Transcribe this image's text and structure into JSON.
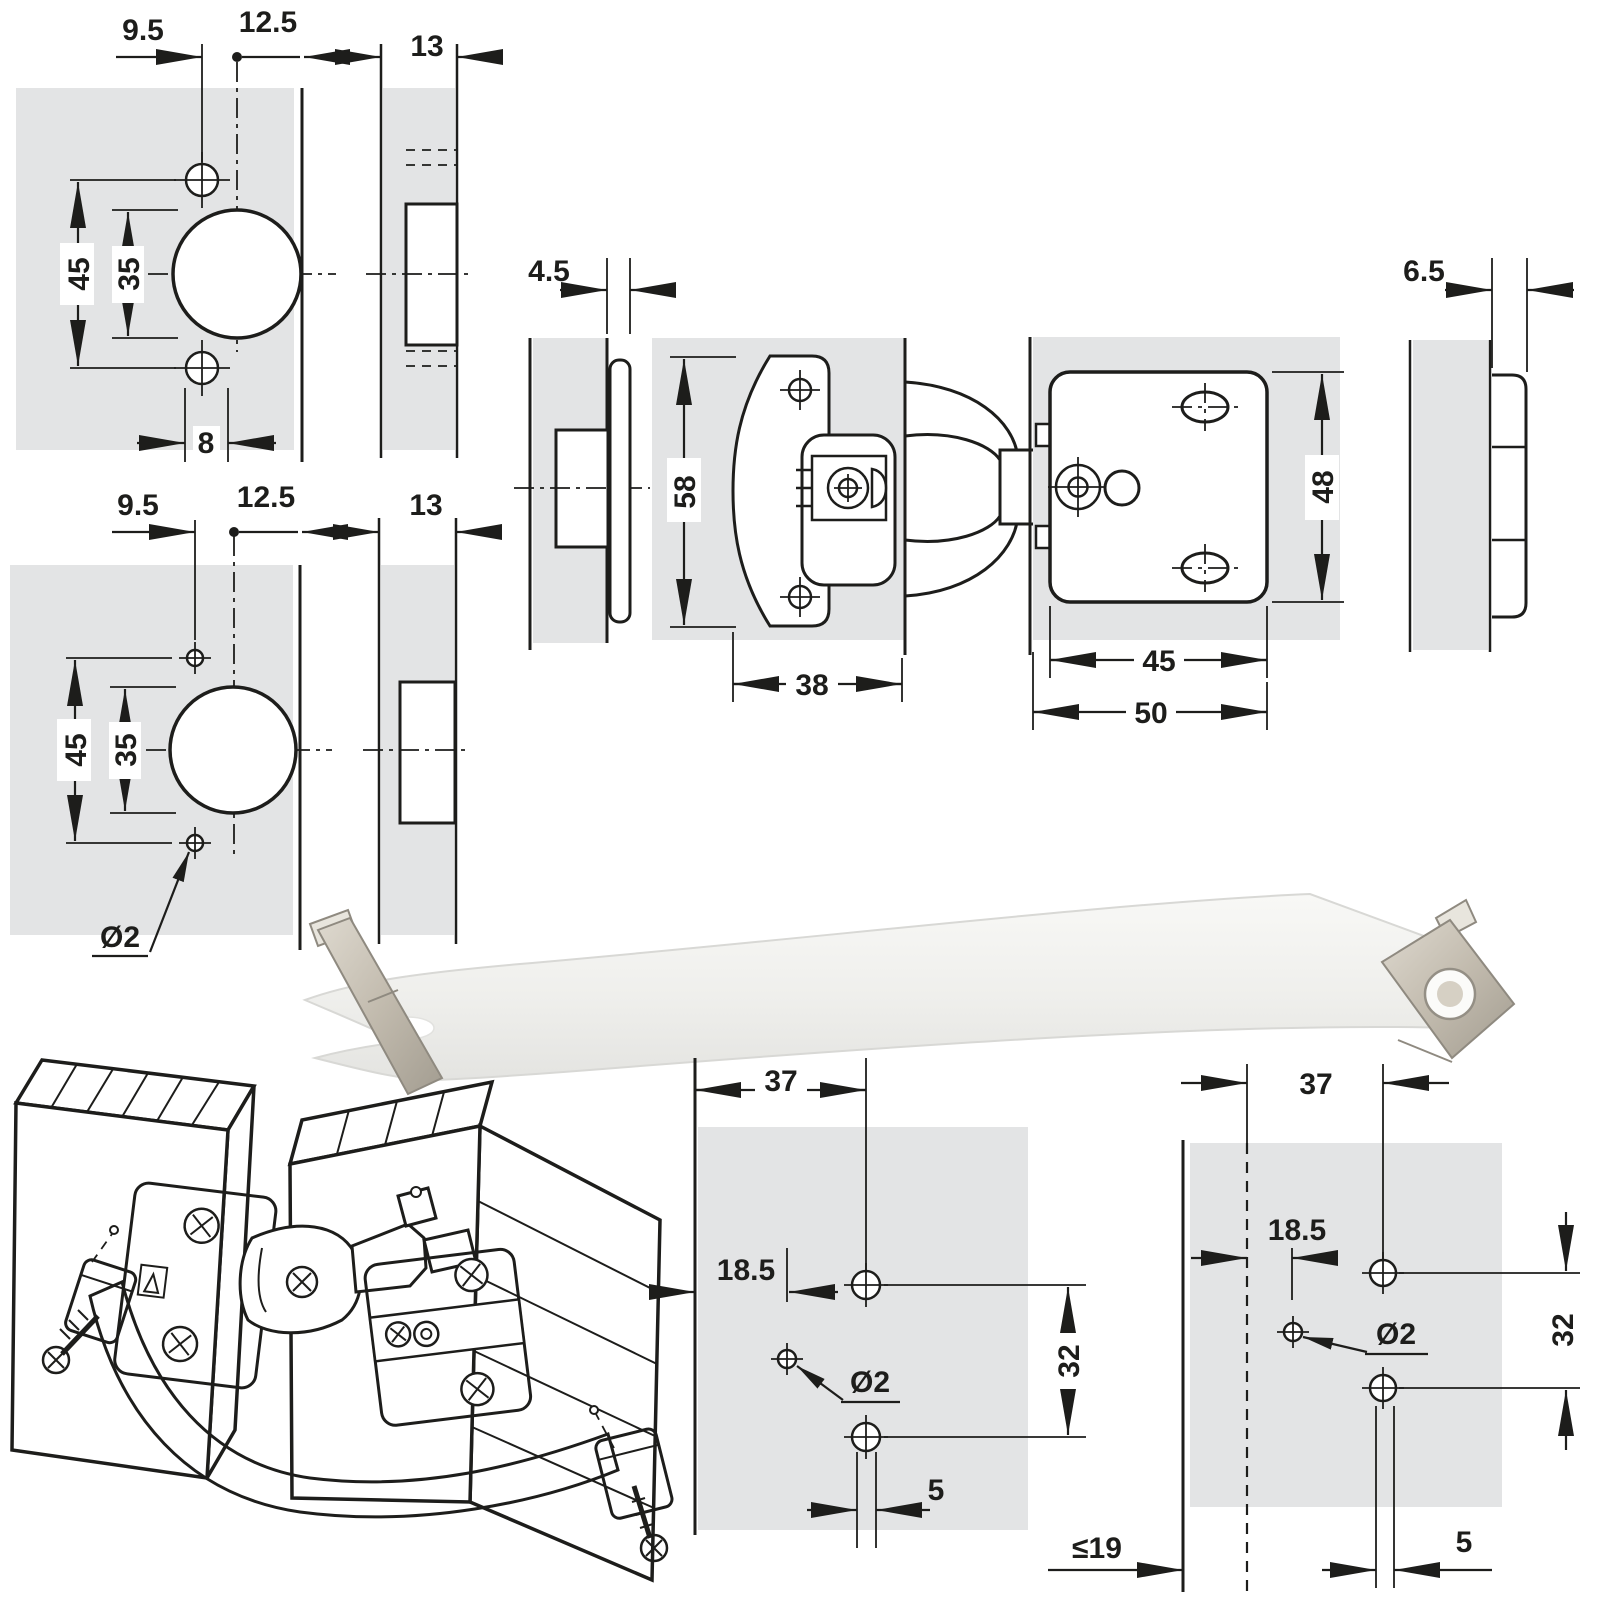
{
  "colors": {
    "background": "#ffffff",
    "panel_fill": "#e3e4e5",
    "line": "#1d1d1b",
    "strap_band": "#f2f2ef",
    "strap_metal": "#c2bbae",
    "iso_strap": "#c9cbcd"
  },
  "diagrams": {
    "cup_pattern_screw": {
      "edge_offset": "9.5",
      "cup_to_edge": "12.5",
      "door_thickness": "13",
      "hole_spacing": "45",
      "cup_diameter": "35",
      "screw_hole_offset": "8"
    },
    "cup_pattern_pilot": {
      "edge_offset": "9.5",
      "cup_to_edge": "12.5",
      "door_thickness": "13",
      "hole_spacing": "45",
      "cup_diameter": "35",
      "pilot_diameter": "Ø2"
    },
    "hinge_assembly": {
      "door_overlay": "4.5",
      "wing_height": "58",
      "wing_depth": "38",
      "plate_overlay": "6.5",
      "plate_height": "48",
      "plate_hole_width": "45",
      "plate_total_width": "50"
    },
    "strap_door_pattern": {
      "hole_distance": "37",
      "edge_offset": "18.5",
      "pilot_diameter": "Ø2",
      "vertical_spacing": "32",
      "hole_gap": "5"
    },
    "strap_cabinet_pattern": {
      "hole_distance": "37",
      "edge_offset": "18.5",
      "pilot_diameter": "Ø2",
      "vertical_spacing": "32",
      "hole_gap": "5",
      "max_thickness": "≤19"
    }
  }
}
